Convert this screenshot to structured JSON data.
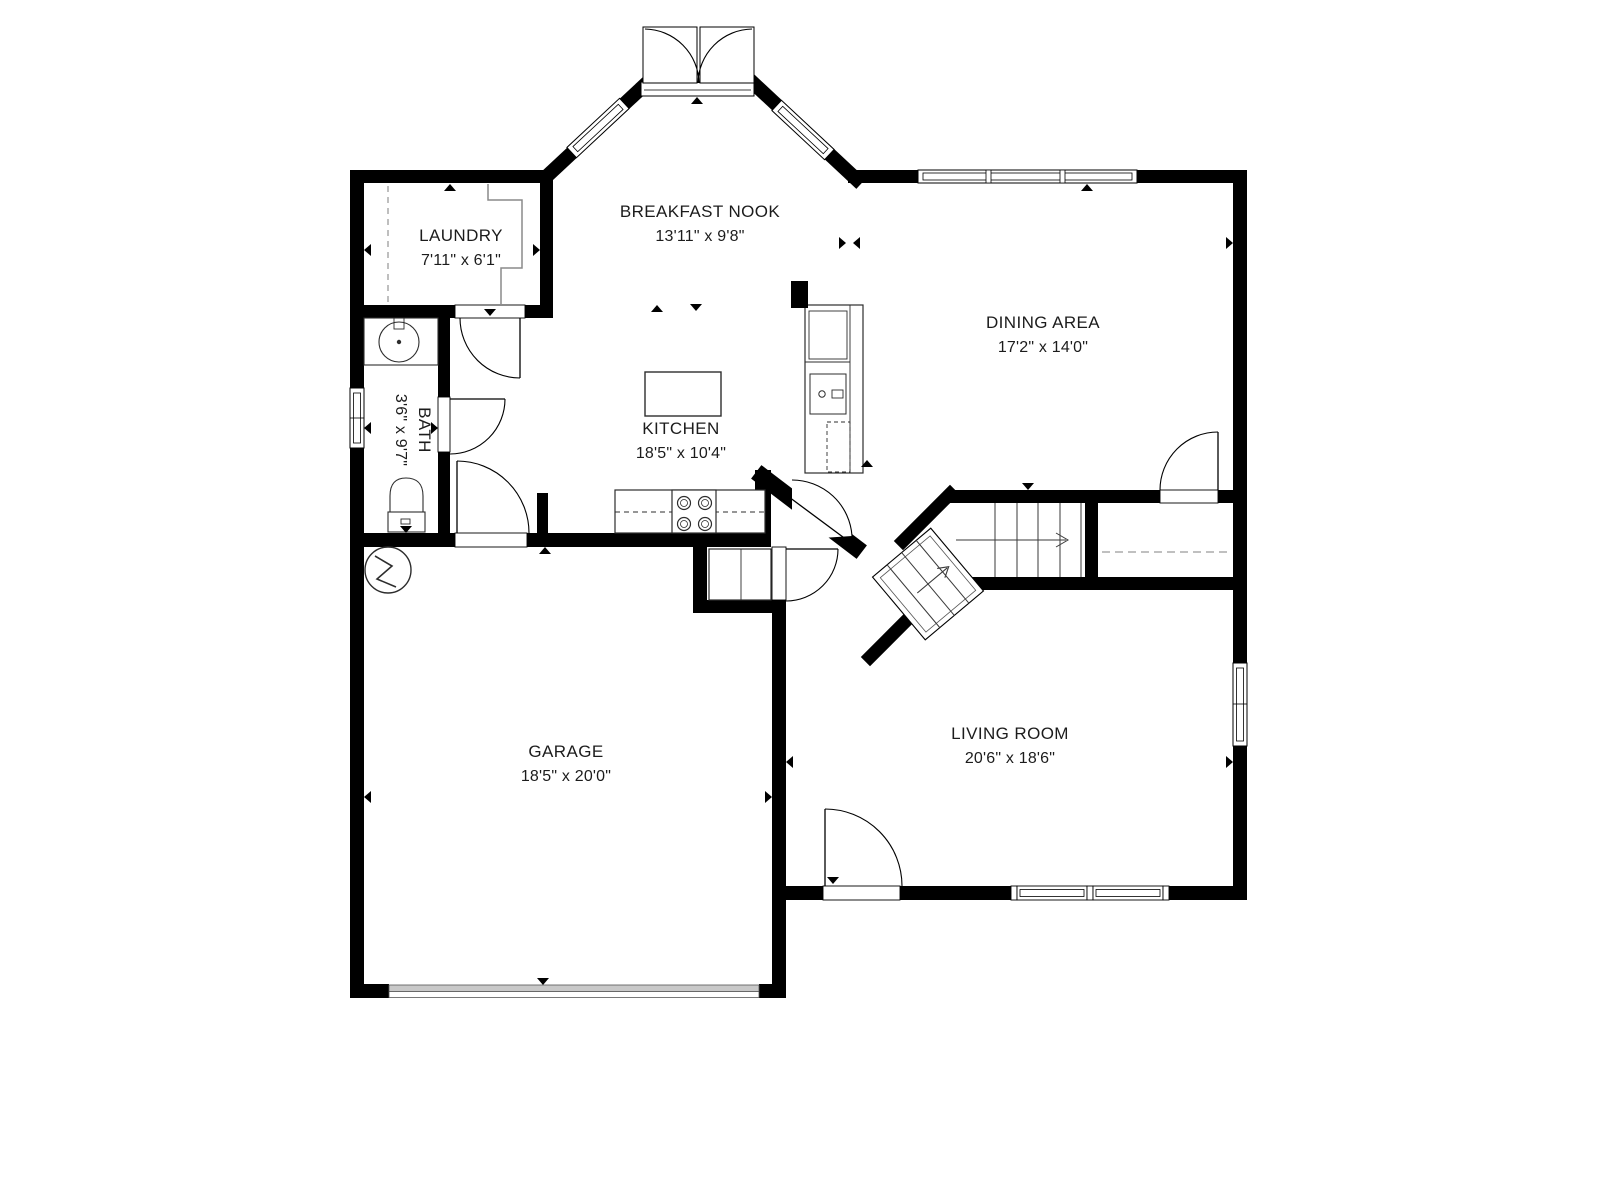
{
  "plan": {
    "rooms": {
      "breakfast_nook": {
        "name": "BREAKFAST NOOK",
        "dims": "13'11\" x 9'8\""
      },
      "dining": {
        "name": "DINING AREA",
        "dims": "17'2\" x 14'0\""
      },
      "laundry": {
        "name": "LAUNDRY",
        "dims": "7'11\" x 6'1\""
      },
      "bath": {
        "name": "BATH",
        "dims": "3'6\" x 9'7\""
      },
      "kitchen": {
        "name": "KITCHEN",
        "dims": "18'5\" x 10'4\""
      },
      "garage": {
        "name": "GARAGE",
        "dims": "18'5\" x 20'0\""
      },
      "living": {
        "name": "LIVING ROOM",
        "dims": "20'6\" x 18'6\""
      }
    },
    "colors": {
      "wall": "#000000",
      "background": "#ffffff",
      "fixture_line": "#2d2d2d",
      "stair_line": "#3a3a3a",
      "dashed_line": "#9a9a9a",
      "garage_door": "#c8c8c8",
      "text": "#1c1c1c"
    }
  }
}
